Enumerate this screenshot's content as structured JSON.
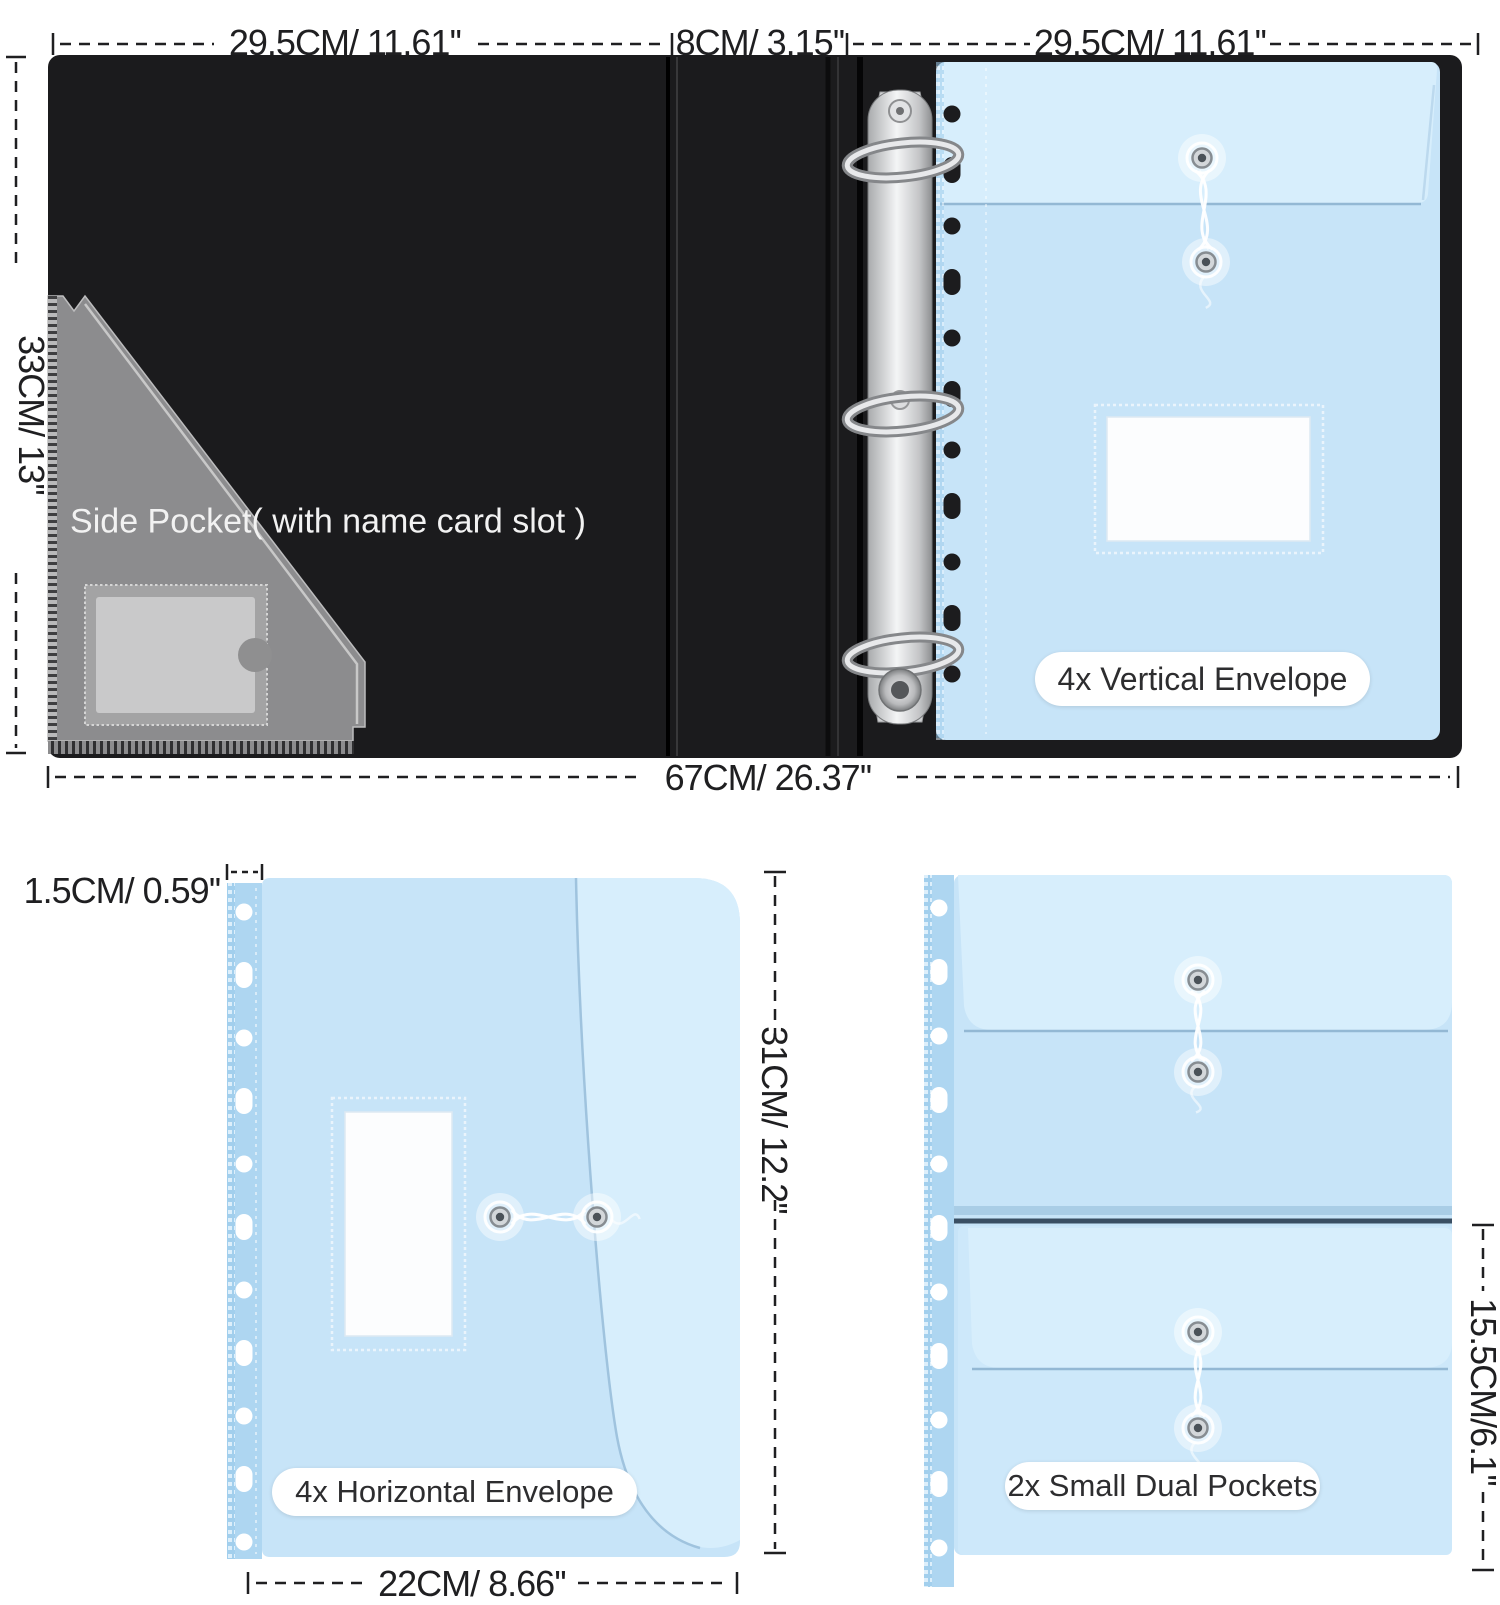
{
  "colors": {
    "binder_black": "#1b1b1d",
    "envelope_blue": "#c7e4f8",
    "flap_blue": "#d7eefc",
    "binding_strip_blue": "#aed6f1",
    "pocket_gray": "#8c8c8e",
    "divider_navy": "#3a4f63",
    "dimension_ink": "#1f1f21",
    "badge_bg": "#ffffff",
    "badge_text": "#2d2d2f"
  },
  "top_section": {
    "dim_width_left": "29.5CM/ 11.61''",
    "dim_width_spine": "8CM/ 3.15''",
    "dim_width_right": "29.5CM/ 11.61''",
    "dim_height": "33CM/ 13''",
    "dim_width_total": "67CM/ 26.37''",
    "side_pocket_label": "Side Pocket( with name card slot )",
    "vertical_envelope_badge": "4x Vertical Envelope"
  },
  "bottom_left_item": {
    "dim_spine_edge": "1.5CM/ 0.59''",
    "dim_height": "31CM/ 12.2''",
    "dim_width": "22CM/ 8.66''",
    "badge": "4x Horizontal Envelope"
  },
  "bottom_right_item": {
    "dim_height": "15.5CM/6.1''",
    "badge": "2x Small Dual Pockets"
  }
}
